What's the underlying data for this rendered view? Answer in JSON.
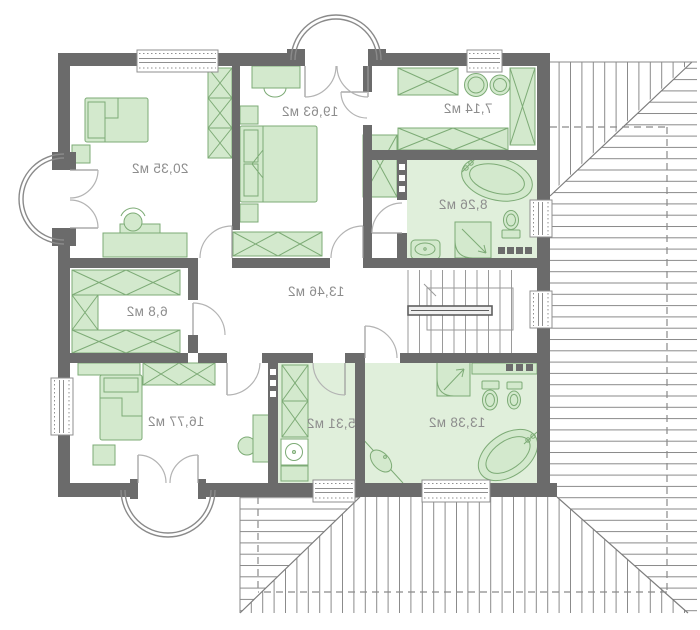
{
  "plan": {
    "type": "floor-plan",
    "unit": "м2",
    "rooms": [
      {
        "id": "bedroom-top-left",
        "area_label": "20,35 м2"
      },
      {
        "id": "bedroom-top-center",
        "area_label": "19,63 м2"
      },
      {
        "id": "walkin-closet",
        "area_label": "7,14 м2"
      },
      {
        "id": "bathroom-upper",
        "area_label": "8,26 м2"
      },
      {
        "id": "hall",
        "area_label": "13,46 м2"
      },
      {
        "id": "closet",
        "area_label": "6,8 м2"
      },
      {
        "id": "bedroom-bottom-left",
        "area_label": "16,77 м2"
      },
      {
        "id": "utility-room",
        "area_label": "5,31 м2"
      },
      {
        "id": "bathroom-lower",
        "area_label": "13,38 м2"
      }
    ],
    "colors": {
      "wall": "#6b6b6b",
      "furniture_fill": "#d3e9cd",
      "furniture_stroke": "#7dab76",
      "bath_floor": "#e0efdb",
      "thin_line": "#9a9a9a",
      "roof_line": "#8a8a8a",
      "label_text": "#8d8d8d",
      "background": "#ffffff"
    }
  }
}
